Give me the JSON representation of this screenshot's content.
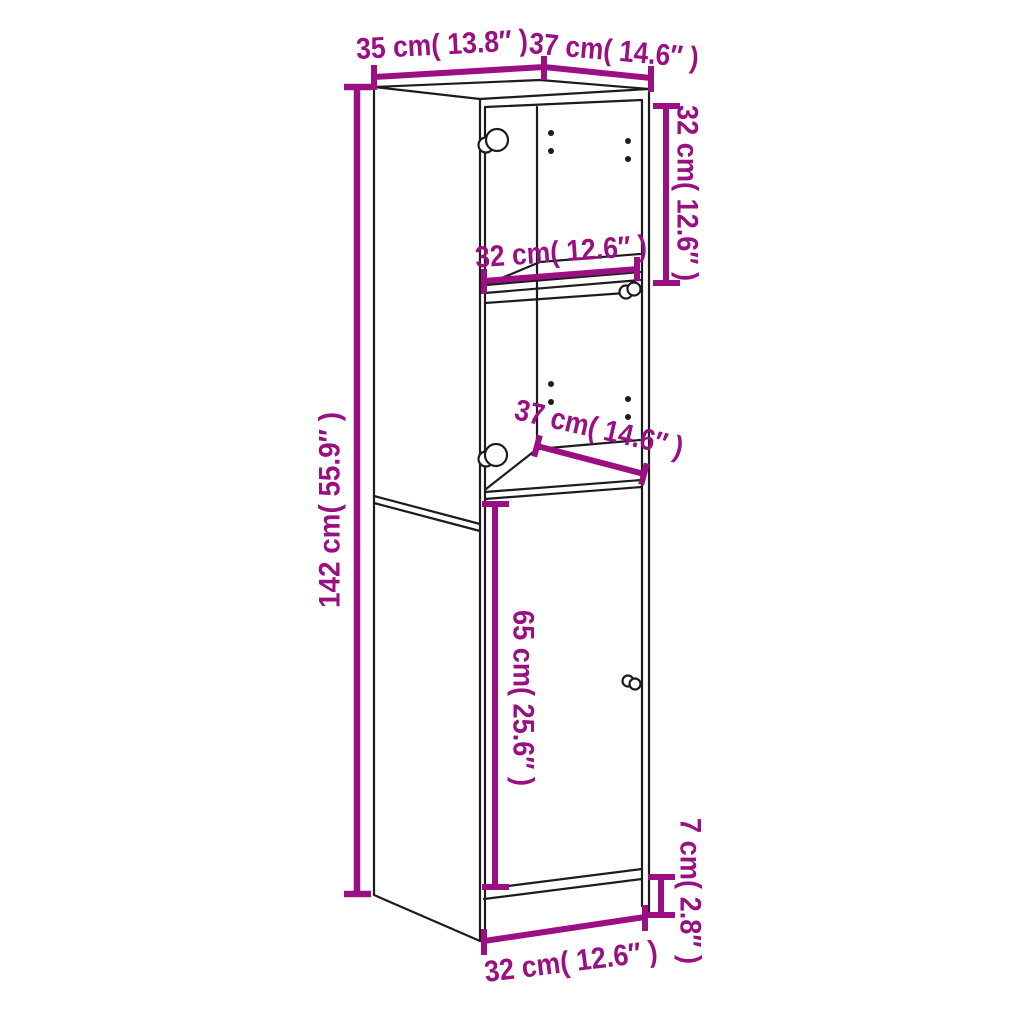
{
  "diagram": {
    "subject": "Tall highboard cabinet with glass doors, interior shelf and lower door, drawn as black perspective line art with magenta dimension callouts",
    "background_color": "#ffffff",
    "line_color": "#1c1c1c",
    "dimension_color": "#9a0f82"
  },
  "dimensions": {
    "top_depth": "35 cm( 13.8″ )",
    "top_width": "37 cm( 14.6″ )",
    "upper_section_height": "32 cm( 12.6″ )",
    "shelf_width": "32 cm( 12.6″ )",
    "interior_depth": "37 cm( 14.6″ )",
    "total_height": "142 cm( 55.9″ )",
    "door_height": "65 cm( 25.6″ )",
    "plinth_height": "7 cm( 2.8″ )",
    "door_width": "32 cm( 12.6″ )"
  }
}
